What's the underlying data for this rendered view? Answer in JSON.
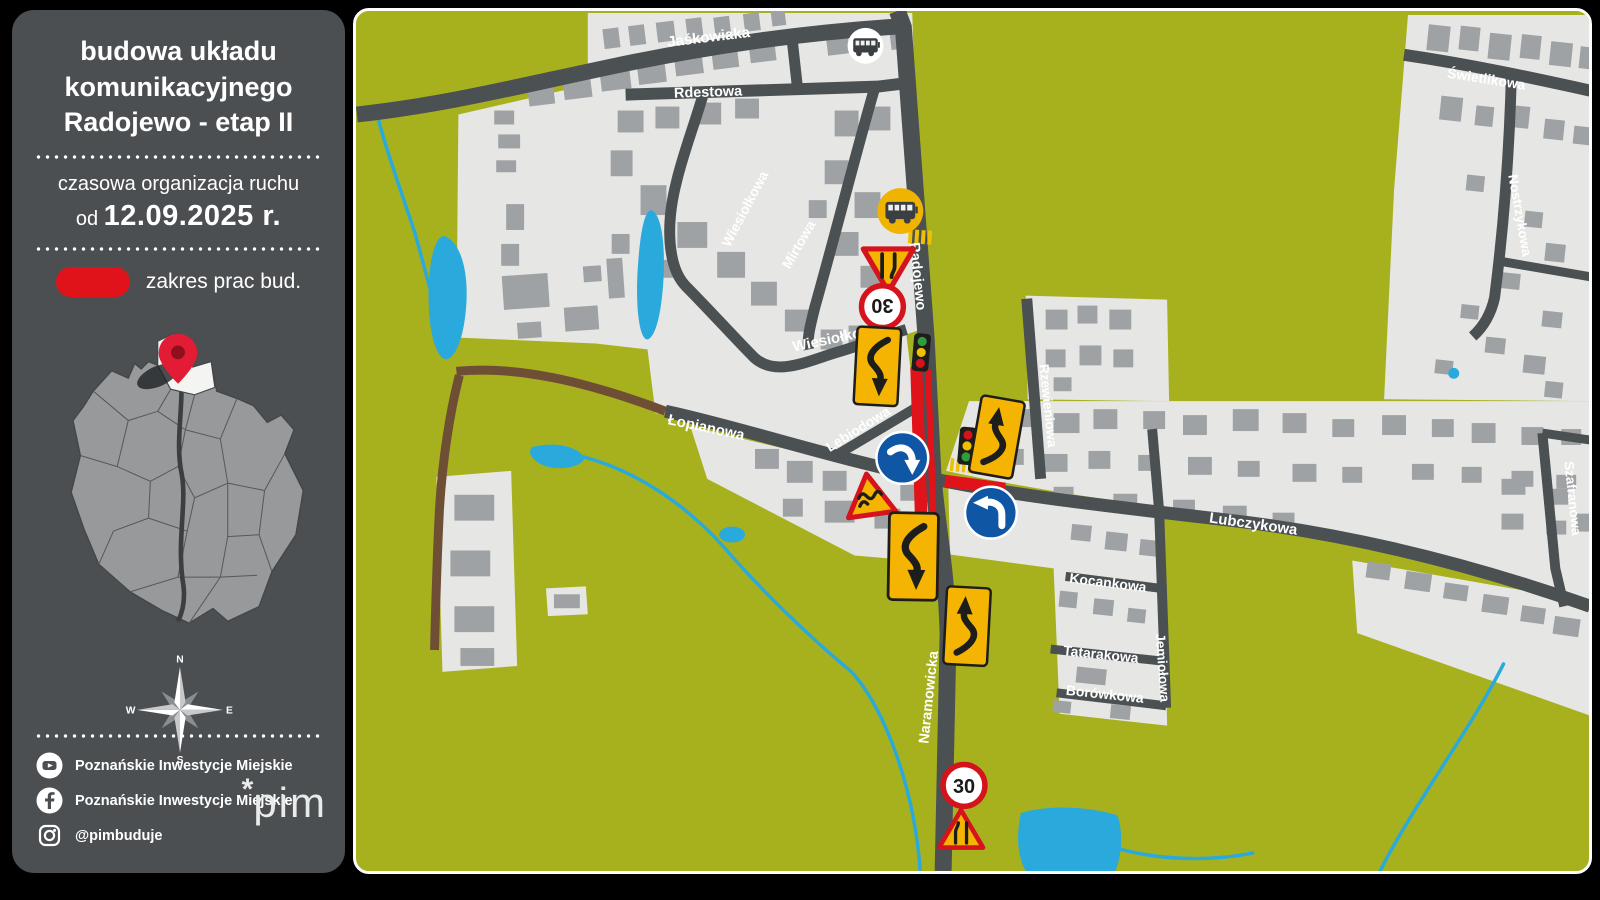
{
  "sidebar": {
    "title": "budowa układu komunikacyjnego Radojewo - etap II",
    "subtitle": "czasowa organizacja ruchu",
    "date_prefix": "od",
    "date": "12.09.2025 r.",
    "legend_label": "zakres prac bud.",
    "compass": {
      "n": "N",
      "e": "E",
      "s": "S",
      "w": "W"
    },
    "social": {
      "youtube_label": "Poznańskie Inwestycje Miejskie",
      "facebook_label": "Poznańskie Inwestycje Miejskie",
      "instagram_label": "@pimbuduje"
    },
    "logo_star": "*",
    "logo_text": "pim"
  },
  "map": {
    "speed_limit": "30",
    "streets": {
      "jaskowiaka": "Jaśkowiaka",
      "rdestowa": "Rdestowa",
      "wiesiolkowa_upper": "Wiesiołkowa",
      "wiesiolkowa_lower": "Wiesiołkowa",
      "mirtowa": "Mirtowa",
      "radojewo": "Radojewo",
      "lebiodowa": "Lebiodowa",
      "lopianowa": "Łopianowa",
      "lubczykowa": "Lubczykowa",
      "rzewieniowa": "Rzewieniowa",
      "kocankowa": "Kocankowa",
      "tatarakowa": "Tatarakowa",
      "borowkowa": "Borówkowa",
      "jemiolowa": "Jemiołowa",
      "swietlikowa": "Świetlikowa",
      "nostrzykowa": "Nostrzykowa",
      "szafranowa": "Szafranowa",
      "naramowicka": "Naramowicka"
    },
    "signs": [
      {
        "id": "bus-stop-north",
        "type": "bus-stop"
      },
      {
        "id": "bus-stop-radojewo",
        "type": "bus-stop"
      },
      {
        "id": "road-narrows-north",
        "type": "warning-road-narrows"
      },
      {
        "id": "speed-limit-north",
        "type": "speed-limit",
        "value": "30"
      },
      {
        "id": "lane-shift-board-north",
        "type": "lane-shift"
      },
      {
        "id": "traffic-signal-north",
        "type": "traffic-signal"
      },
      {
        "id": "mandatory-right-turn",
        "type": "mandatory-turn"
      },
      {
        "id": "uneven-road",
        "type": "warning-uneven-road"
      },
      {
        "id": "traffic-signal-east",
        "type": "traffic-signal"
      },
      {
        "id": "lane-shift-board-east",
        "type": "lane-shift"
      },
      {
        "id": "mandatory-left-turn",
        "type": "mandatory-turn"
      },
      {
        "id": "lane-shift-board-south",
        "type": "lane-shift"
      },
      {
        "id": "lane-shift-board-naramowicka",
        "type": "lane-shift"
      },
      {
        "id": "speed-limit-south",
        "type": "speed-limit",
        "value": "30"
      },
      {
        "id": "road-narrows-south",
        "type": "warning-road-narrows"
      }
    ],
    "colors": {
      "land": "#a7b11e",
      "residential": "#e6e6e4",
      "building": "#9fa2a4",
      "road": "#4b5053",
      "dirt_road": "#6e4f36",
      "water": "#2aa9dc",
      "construction": "#e0131b",
      "sign_yellow": "#f5b402",
      "sign_blue": "#0f57a5",
      "sign_red": "#d5131c"
    }
  }
}
